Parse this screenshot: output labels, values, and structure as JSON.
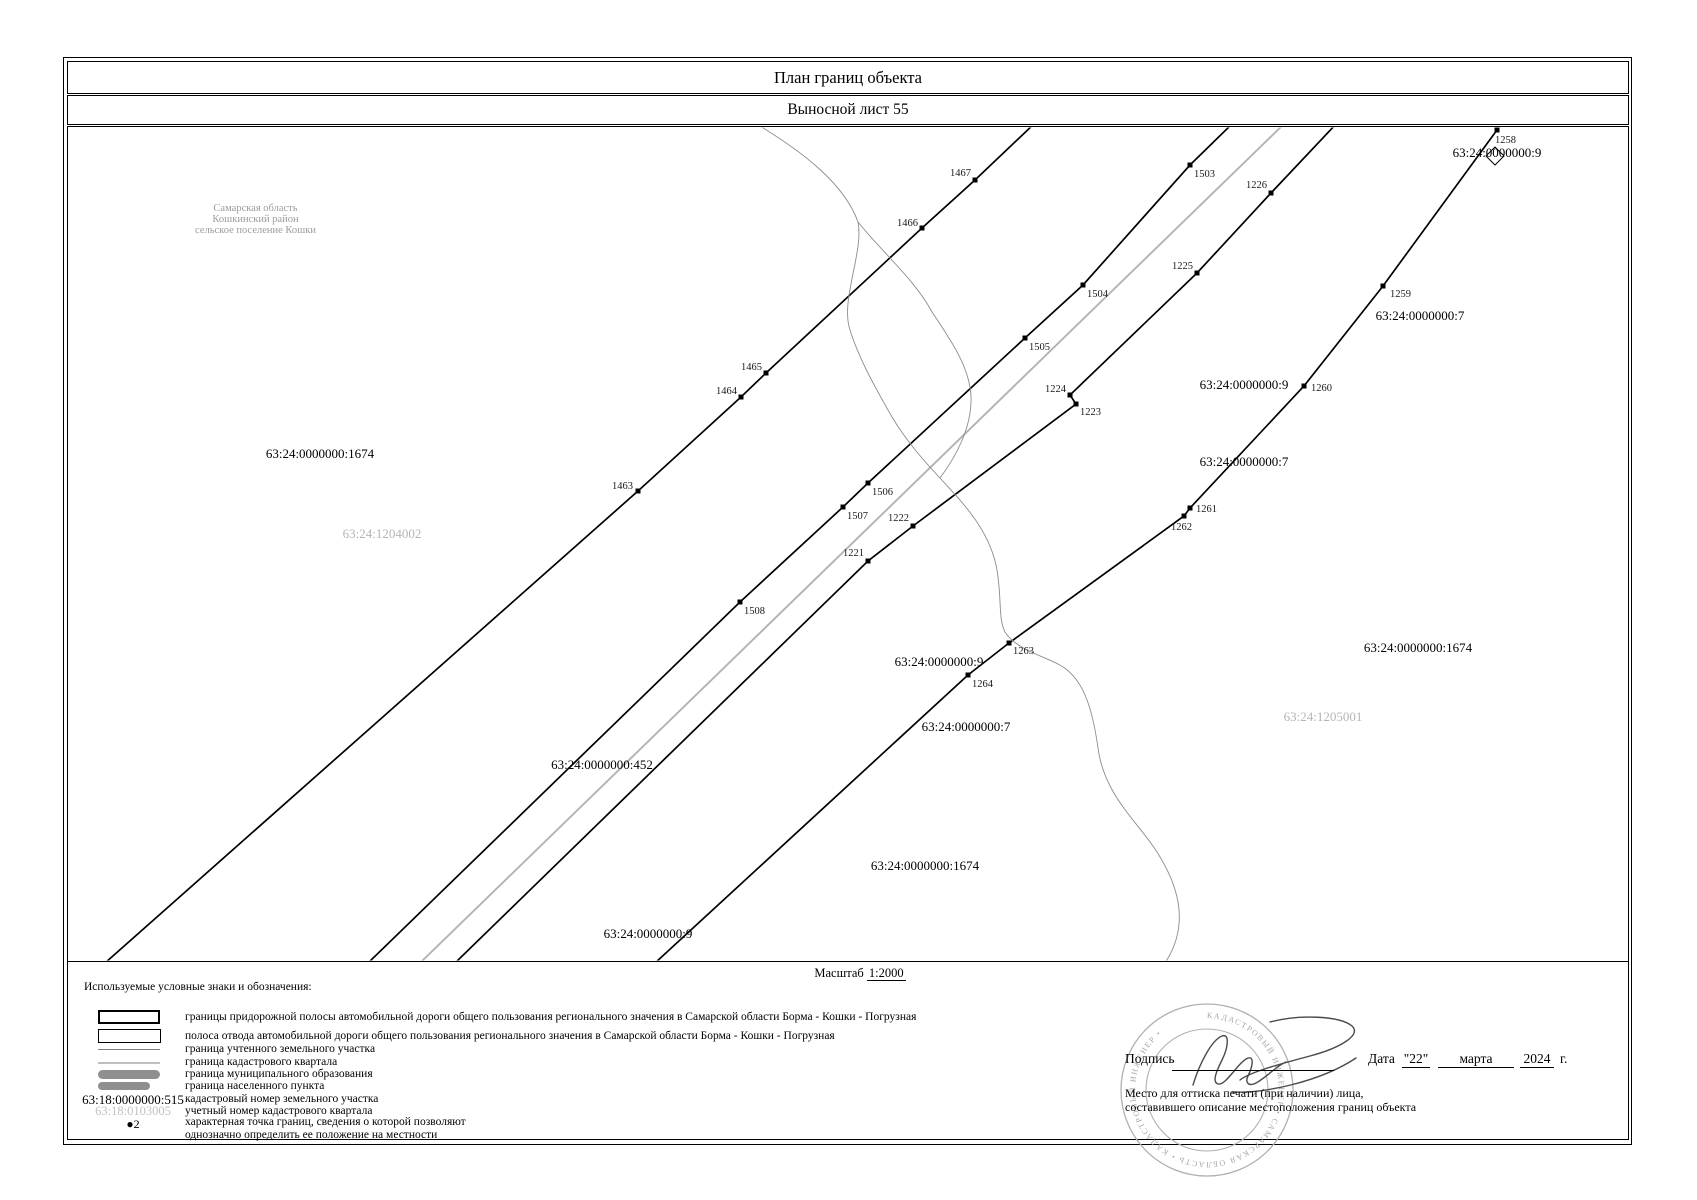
{
  "title": "План границ объекта",
  "subtitle": "Выносной лист 55",
  "region_note": {
    "line1": "Самарская область",
    "line2": "Кошкинский район",
    "line3": "сельское поселение Кошки"
  },
  "scale": {
    "prefix": "Масштаб",
    "value": "1:2000"
  },
  "legend": {
    "heading": "Используемые условные знаки и обозначения:",
    "items": [
      {
        "symbol": "roadside-strip-rect-thick",
        "label": "границы придорожной полосы автомобильной дороги общего пользования регионального значения в Самарской области Борма - Кошки - Погрузная"
      },
      {
        "symbol": "right-of-way-rect-thin",
        "label": "полоса отвода автомобильной дороги общего пользования регионального значения в Самарской области Борма - Кошки - Погрузная"
      },
      {
        "symbol": "registered-parcel-line",
        "label": "граница учтенного земельного участка"
      },
      {
        "symbol": "cadastral-quarter-line",
        "label": "граница кадастрового квартала"
      },
      {
        "symbol": "municipal-boundary-bar",
        "label": "граница муниципального образования"
      },
      {
        "symbol": "settlement-boundary-bar",
        "label": "граница населенного пункта"
      },
      {
        "symbol": "parcel-number-sample",
        "key": "63:18:0000000:515",
        "label": "кадастровый номер земельного участка"
      },
      {
        "symbol": "quarter-number-sample",
        "key": "63:18:0103005",
        "label": "учетный номер кадастрового квартала"
      },
      {
        "symbol": "char-point-sample",
        "bullet": "●",
        "key": "2",
        "label_line1": "характерная точка границ, сведения о которой позволяют",
        "label_line2": "однозначно определить ее положение на местности"
      }
    ]
  },
  "signature": {
    "sign_label": "Подпись",
    "date_label": "Дата",
    "date_day": "\"22\"",
    "date_month": "марта",
    "date_year": "2024",
    "date_suffix": "г.",
    "stamp_note_line1": "Место для оттиска печати (при наличии) лица,",
    "stamp_note_line2": "составившего описание местоположения границ объекта",
    "stamp_ring_text": "КАДАСТРОВЫЙ ИНЖЕНЕР • САМАРСКАЯ ОБЛАСТЬ • КАДАСТРОВЫЙ ИНЖЕНЕР •"
  },
  "map": {
    "colors": {
      "boundary": "#000000",
      "quarter_line": "#b3b3b3",
      "stream": "#8c8c8c",
      "gray_label": "#b5b5b5",
      "point_label": "#1a1a1a"
    },
    "lines": [
      {
        "name": "roadside-boundary-1",
        "type": "black",
        "points": [
          [
            105,
            963
          ],
          [
            638,
            491
          ],
          [
            741,
            397
          ],
          [
            766,
            373
          ],
          [
            922,
            228
          ],
          [
            975,
            180
          ],
          [
            1035,
            123
          ]
        ]
      },
      {
        "name": "roadside-boundary-2",
        "type": "black",
        "points": [
          [
            368,
            963
          ],
          [
            740,
            602
          ],
          [
            843,
            507
          ],
          [
            868,
            483
          ],
          [
            1025,
            338
          ],
          [
            1083,
            285
          ],
          [
            1190,
            165
          ],
          [
            1233,
            123
          ]
        ]
      },
      {
        "name": "cadastral-quarter-boundary",
        "type": "gray",
        "points": [
          [
            420,
            963
          ],
          [
            1285,
            123
          ]
        ]
      },
      {
        "name": "roadside-boundary-3",
        "type": "black",
        "points": [
          [
            455,
            963
          ],
          [
            868,
            561
          ],
          [
            913,
            526
          ],
          [
            1076,
            404
          ],
          [
            1070,
            395
          ],
          [
            1197,
            273
          ],
          [
            1271,
            193
          ],
          [
            1337,
            123
          ]
        ]
      },
      {
        "name": "roadside-boundary-4",
        "type": "black",
        "points": [
          [
            655,
            963
          ],
          [
            968,
            675
          ],
          [
            1009,
            643
          ],
          [
            1184,
            516
          ],
          [
            1190,
            508
          ],
          [
            1304,
            386
          ],
          [
            1383,
            286
          ],
          [
            1497,
            130
          ],
          [
            1502,
            123
          ]
        ]
      }
    ],
    "streams": [
      "M755,123 C805,153 845,185 858,222 C864,252 840,300 850,330 C858,356 872,382 892,417 C907,442 925,462 940,478",
      "M858,222 C882,252 915,280 932,312 C952,342 970,368 971,397 C972,428 955,458 940,478",
      "M940,478 C962,502 990,530 997,570 C1002,600 998,618 1005,632 C1015,648 1040,655 1058,664 C1082,676 1092,705 1098,748 C1104,795 1138,822 1157,852 C1176,882 1192,922 1165,963"
    ],
    "diamond": {
      "x": 1495,
      "y": 156
    },
    "points": [
      {
        "id": "1463",
        "x": 638,
        "y": 491,
        "anchor": "end",
        "lx": 633,
        "ly": 489
      },
      {
        "id": "1464",
        "x": 741,
        "y": 397,
        "anchor": "end",
        "lx": 737,
        "ly": 394
      },
      {
        "id": "1465",
        "x": 766,
        "y": 373,
        "anchor": "end",
        "lx": 762,
        "ly": 370
      },
      {
        "id": "1466",
        "x": 922,
        "y": 228,
        "anchor": "end",
        "lx": 918,
        "ly": 226
      },
      {
        "id": "1467",
        "x": 975,
        "y": 180,
        "anchor": "end",
        "lx": 971,
        "ly": 176
      },
      {
        "id": "1503",
        "x": 1190,
        "y": 165,
        "anchor": "start",
        "lx": 1194,
        "ly": 177
      },
      {
        "id": "1504",
        "x": 1083,
        "y": 285,
        "anchor": "start",
        "lx": 1087,
        "ly": 297
      },
      {
        "id": "1505",
        "x": 1025,
        "y": 338,
        "anchor": "start",
        "lx": 1029,
        "ly": 350
      },
      {
        "id": "1506",
        "x": 868,
        "y": 483,
        "anchor": "start",
        "lx": 872,
        "ly": 495
      },
      {
        "id": "1507",
        "x": 843,
        "y": 507,
        "anchor": "start",
        "lx": 847,
        "ly": 519
      },
      {
        "id": "1508",
        "x": 740,
        "y": 602,
        "anchor": "start",
        "lx": 744,
        "ly": 614
      },
      {
        "id": "1221",
        "x": 868,
        "y": 561,
        "anchor": "end",
        "lx": 864,
        "ly": 556
      },
      {
        "id": "1222",
        "x": 913,
        "y": 526,
        "anchor": "end",
        "lx": 909,
        "ly": 521
      },
      {
        "id": "1223",
        "x": 1076,
        "y": 404,
        "anchor": "start",
        "lx": 1080,
        "ly": 415
      },
      {
        "id": "1224",
        "x": 1070,
        "y": 395,
        "anchor": "end",
        "lx": 1066,
        "ly": 392
      },
      {
        "id": "1225",
        "x": 1197,
        "y": 273,
        "anchor": "end",
        "lx": 1193,
        "ly": 269
      },
      {
        "id": "1226",
        "x": 1271,
        "y": 193,
        "anchor": "end",
        "lx": 1267,
        "ly": 188
      },
      {
        "id": "1264",
        "x": 968,
        "y": 675,
        "anchor": "start",
        "lx": 972,
        "ly": 687
      },
      {
        "id": "1263",
        "x": 1009,
        "y": 643,
        "anchor": "start",
        "lx": 1013,
        "ly": 654
      },
      {
        "id": "1262",
        "x": 1184,
        "y": 516,
        "anchor": "end",
        "lx": 1192,
        "ly": 530
      },
      {
        "id": "1261",
        "x": 1190,
        "y": 508,
        "anchor": "start",
        "lx": 1196,
        "ly": 512
      },
      {
        "id": "1260",
        "x": 1304,
        "y": 386,
        "anchor": "start",
        "lx": 1311,
        "ly": 391
      },
      {
        "id": "1259",
        "x": 1383,
        "y": 286,
        "anchor": "start",
        "lx": 1390,
        "ly": 297
      },
      {
        "id": "1258",
        "x": 1497,
        "y": 130,
        "anchor": "start",
        "lx": 1495,
        "ly": 143
      }
    ],
    "labels": [
      {
        "text": "63:24:0000000:9",
        "x": 1497,
        "y": 153,
        "color": "black"
      },
      {
        "text": "63:24:0000000:7",
        "x": 1420,
        "y": 316,
        "color": "black"
      },
      {
        "text": "63:24:0000000:9",
        "x": 1244,
        "y": 385,
        "color": "black"
      },
      {
        "text": "63:24:0000000:7",
        "x": 1244,
        "y": 462,
        "color": "black"
      },
      {
        "text": "63:24:0000000:1674",
        "x": 1418,
        "y": 648,
        "color": "black"
      },
      {
        "text": "63:24:1205001",
        "x": 1323,
        "y": 717,
        "color": "gray"
      },
      {
        "text": "63:24:0000000:9",
        "x": 939,
        "y": 662,
        "color": "black"
      },
      {
        "text": "63:24:0000000:7",
        "x": 966,
        "y": 727,
        "color": "black"
      },
      {
        "text": "63:24:0000000:1674",
        "x": 925,
        "y": 866,
        "color": "black"
      },
      {
        "text": "63:24:0000000:9",
        "x": 648,
        "y": 934,
        "color": "black"
      },
      {
        "text": "63:24:0000000:452",
        "x": 602,
        "y": 765,
        "color": "black"
      },
      {
        "text": "63:24:0000000:1674",
        "x": 320,
        "y": 454,
        "color": "black"
      },
      {
        "text": "63:24:1204002",
        "x": 382,
        "y": 534,
        "color": "gray"
      }
    ]
  }
}
